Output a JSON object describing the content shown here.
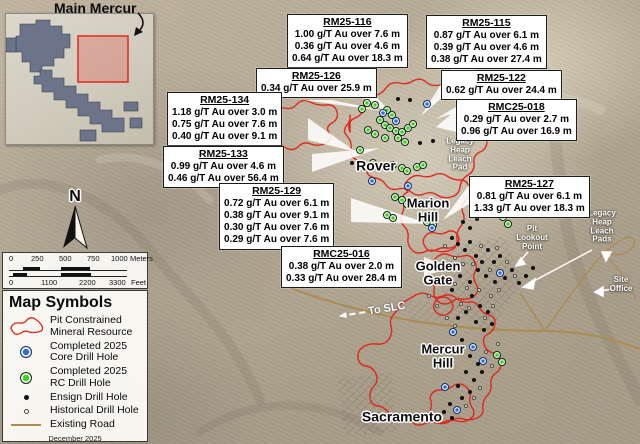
{
  "inset": {
    "title": "Main Mercur"
  },
  "north_label": "N",
  "scalebar": {
    "meters": {
      "ticks": [
        "0",
        "250",
        "500",
        "750",
        "1000"
      ],
      "unit": "Meters"
    },
    "feet": {
      "ticks": [
        "0",
        "1100",
        "2200",
        "3300"
      ],
      "unit": "Feet"
    }
  },
  "legend": {
    "title": "Map Symbols",
    "date": "December 2025",
    "items": [
      {
        "symbol": "pit-outline",
        "label": "Pit Constrained\nMineral Resource"
      },
      {
        "symbol": "core-hole",
        "label": "Completed 2025\nCore Drill Hole"
      },
      {
        "symbol": "rc-hole",
        "label": "Completed 2025\nRC Drill Hole"
      },
      {
        "symbol": "ensign-hole",
        "label": "Ensign Drill Hole"
      },
      {
        "symbol": "historical-hole",
        "label": "Historical Drill Hole"
      },
      {
        "symbol": "road",
        "label": "Existing Road"
      }
    ]
  },
  "callouts": [
    {
      "id": "RM25-116",
      "x": 287,
      "y": 14,
      "lines": [
        "1.00 g/T Au over 7.6 m",
        "0.36 g/T Au over 4.6 m",
        "0.64 g/T Au over 18.3 m"
      ]
    },
    {
      "id": "RM25-115",
      "x": 426,
      "y": 15,
      "lines": [
        "0.87 g/T Au over 6.1 m",
        "0.39 g/T Au over 4.6 m",
        "0.38 g/T Au over 27.4 m"
      ]
    },
    {
      "id": "RM25-126",
      "x": 256,
      "y": 68,
      "lines": [
        "0.34 g/T Au over 25.9 m"
      ]
    },
    {
      "id": "RM25-122",
      "x": 441,
      "y": 70,
      "lines": [
        "0.62 g/T Au over 24.4 m"
      ]
    },
    {
      "id": "RM25-134",
      "x": 167,
      "y": 92,
      "lines": [
        "1.18 g/T Au over 3.0 m",
        "0.75 g/T Au over 7.6 m",
        "0.40 g/T Au over 9.1 m"
      ]
    },
    {
      "id": "RMC25-018",
      "x": 456,
      "y": 99,
      "lines": [
        "0.29 g/T Au over 2.7 m",
        "0.96 g/T Au over 16.9 m"
      ]
    },
    {
      "id": "RM25-133",
      "x": 163,
      "y": 146,
      "lines": [
        "0.99 g/T Au over 4.6 m",
        "0.46 g/T Au over 56.4 m"
      ]
    },
    {
      "id": "RM25-127",
      "x": 469,
      "y": 176,
      "lines": [
        "0.81 g/T Au over 6.1 m",
        "1.33 g/T Au over 18.3 m"
      ]
    },
    {
      "id": "RM25-129",
      "x": 219,
      "y": 183,
      "lines": [
        "0.72 g/T Au over 6.1 m",
        "0.38 g/T Au over 9.1 m",
        "0.30 g/T Au over 7.6 m",
        "0.29 g/T Au over 7.6 m"
      ]
    },
    {
      "id": "RMC25-016",
      "x": 281,
      "y": 246,
      "lines": [
        "0.38 g/T Au over 2.0 m",
        "0.33 g/T Au over 28.4 m"
      ]
    }
  ],
  "map_labels": [
    {
      "text": "Rover",
      "x": 376,
      "y": 166,
      "cls": "place",
      "fs": 14
    },
    {
      "text": "Marion\nHill",
      "x": 428,
      "y": 210,
      "cls": "place",
      "fs": 13
    },
    {
      "text": "Golden\nGate",
      "x": 438,
      "y": 273,
      "cls": "place",
      "fs": 13
    },
    {
      "text": "Mercur\nHill",
      "x": 443,
      "y": 356,
      "cls": "place",
      "fs": 13
    },
    {
      "text": "Sacramento",
      "x": 402,
      "y": 417,
      "cls": "place",
      "fs": 14
    },
    {
      "text": "Legacy\nHeap\nLeach\nPad",
      "x": 460,
      "y": 155,
      "cls": "wsm"
    },
    {
      "text": "Pit\nLookout\nPoint",
      "x": 532,
      "y": 238,
      "cls": "wsm"
    },
    {
      "text": "Legacy\nHeap\nLeach\nPads",
      "x": 602,
      "y": 227,
      "cls": "wsm"
    },
    {
      "text": "Site\nOffice",
      "x": 621,
      "y": 285,
      "cls": "wsm"
    },
    {
      "text": "To SLC",
      "x": 372,
      "y": 311,
      "cls": "slc",
      "rot": -9
    }
  ],
  "drill_holes": {
    "rc": [
      [
        360,
        150
      ],
      [
        367,
        103
      ],
      [
        362,
        109
      ],
      [
        375,
        105
      ],
      [
        387,
        110
      ],
      [
        392,
        115
      ],
      [
        380,
        120
      ],
      [
        385,
        125
      ],
      [
        390,
        128
      ],
      [
        396,
        131
      ],
      [
        402,
        132
      ],
      [
        408,
        128
      ],
      [
        413,
        124
      ],
      [
        398,
        138
      ],
      [
        405,
        142
      ],
      [
        385,
        138
      ],
      [
        375,
        134
      ],
      [
        368,
        130
      ],
      [
        373,
        163
      ],
      [
        393,
        165
      ],
      [
        402,
        168
      ],
      [
        407,
        171
      ],
      [
        417,
        167
      ],
      [
        423,
        165
      ],
      [
        395,
        197
      ],
      [
        402,
        200
      ],
      [
        407,
        204
      ],
      [
        387,
        215
      ],
      [
        393,
        218
      ],
      [
        427,
        222
      ],
      [
        433,
        225
      ],
      [
        503,
        217
      ],
      [
        508,
        224
      ],
      [
        497,
        355
      ],
      [
        502,
        362
      ]
    ],
    "core": [
      [
        383,
        113
      ],
      [
        396,
        121
      ],
      [
        427,
        104
      ],
      [
        372,
        181
      ],
      [
        408,
        186
      ],
      [
        432,
        228
      ],
      [
        500,
        273
      ],
      [
        453,
        332
      ],
      [
        473,
        347
      ],
      [
        483,
        361
      ],
      [
        445,
        387
      ],
      [
        457,
        410
      ]
    ],
    "ensign": [
      [
        398,
        99
      ],
      [
        410,
        100
      ],
      [
        352,
        163
      ],
      [
        420,
        143
      ],
      [
        433,
        141
      ],
      [
        463,
        222
      ],
      [
        470,
        228
      ],
      [
        477,
        219
      ],
      [
        452,
        238
      ],
      [
        458,
        244
      ],
      [
        465,
        250
      ],
      [
        470,
        242
      ],
      [
        476,
        256
      ],
      [
        482,
        262
      ],
      [
        488,
        250
      ],
      [
        494,
        262
      ],
      [
        500,
        256
      ],
      [
        478,
        270
      ],
      [
        486,
        276
      ],
      [
        495,
        282
      ],
      [
        505,
        278
      ],
      [
        512,
        270
      ],
      [
        470,
        282
      ],
      [
        460,
        276
      ],
      [
        452,
        290
      ],
      [
        472,
        296
      ],
      [
        480,
        306
      ],
      [
        488,
        312
      ],
      [
        466,
        312
      ],
      [
        458,
        318
      ],
      [
        476,
        322
      ],
      [
        484,
        330
      ],
      [
        492,
        324
      ],
      [
        462,
        340
      ],
      [
        470,
        356
      ],
      [
        478,
        364
      ],
      [
        466,
        372
      ],
      [
        474,
        380
      ],
      [
        482,
        372
      ],
      [
        458,
        386
      ],
      [
        470,
        392
      ],
      [
        462,
        398
      ],
      [
        450,
        404
      ],
      [
        444,
        412
      ],
      [
        452,
        418
      ],
      [
        519,
        283
      ],
      [
        526,
        276
      ],
      [
        533,
        268
      ]
    ],
    "historical": [
      [
        445,
        246
      ],
      [
        455,
        258
      ],
      [
        463,
        264
      ],
      [
        473,
        264
      ],
      [
        481,
        246
      ],
      [
        490,
        270
      ],
      [
        497,
        248
      ],
      [
        507,
        262
      ],
      [
        515,
        276
      ],
      [
        449,
        270
      ],
      [
        443,
        282
      ],
      [
        455,
        284
      ],
      [
        467,
        288
      ],
      [
        479,
        290
      ],
      [
        491,
        296
      ],
      [
        499,
        290
      ],
      [
        461,
        304
      ],
      [
        469,
        308
      ],
      [
        485,
        318
      ],
      [
        493,
        306
      ],
      [
        455,
        326
      ],
      [
        447,
        318
      ],
      [
        437,
        306
      ],
      [
        429,
        296
      ],
      [
        480,
        388
      ],
      [
        474,
        398
      ],
      [
        466,
        406
      ],
      [
        486,
        352
      ],
      [
        492,
        366
      ],
      [
        498,
        344
      ]
    ]
  },
  "colors": {
    "pit_red": "#e0231a",
    "core_blue": "#2e6be0",
    "rc_green": "#3fcf23",
    "road_tan": "#a98e53",
    "claim_gray": "#6b7488",
    "inset_highlight_red": "#e03228"
  }
}
